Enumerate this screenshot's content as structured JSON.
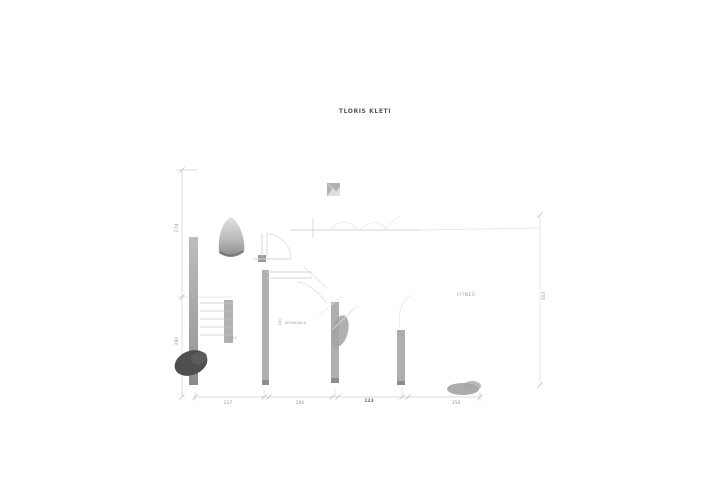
{
  "drawing": {
    "title": "TLORIS KLETI",
    "rooms": {
      "fitnes": "FITNES",
      "kopalnica": "KOPALNICA",
      "kopalnica_width": "160"
    },
    "stairs": {
      "label": "16x17"
    },
    "dimensions": {
      "left": [
        "274",
        "280"
      ],
      "right": [
        "503"
      ],
      "bottom": [
        "217",
        "260",
        "123",
        "358"
      ]
    },
    "icons": {
      "marker": "image-placeholder-icon"
    },
    "colors": {
      "background": "#ffffff",
      "wall_gray": "#a9a9a9",
      "dark_blob": "#4f4f4f",
      "line_light": "#d6d6d6",
      "label_text": "#999999",
      "title_text": "#555555"
    }
  }
}
